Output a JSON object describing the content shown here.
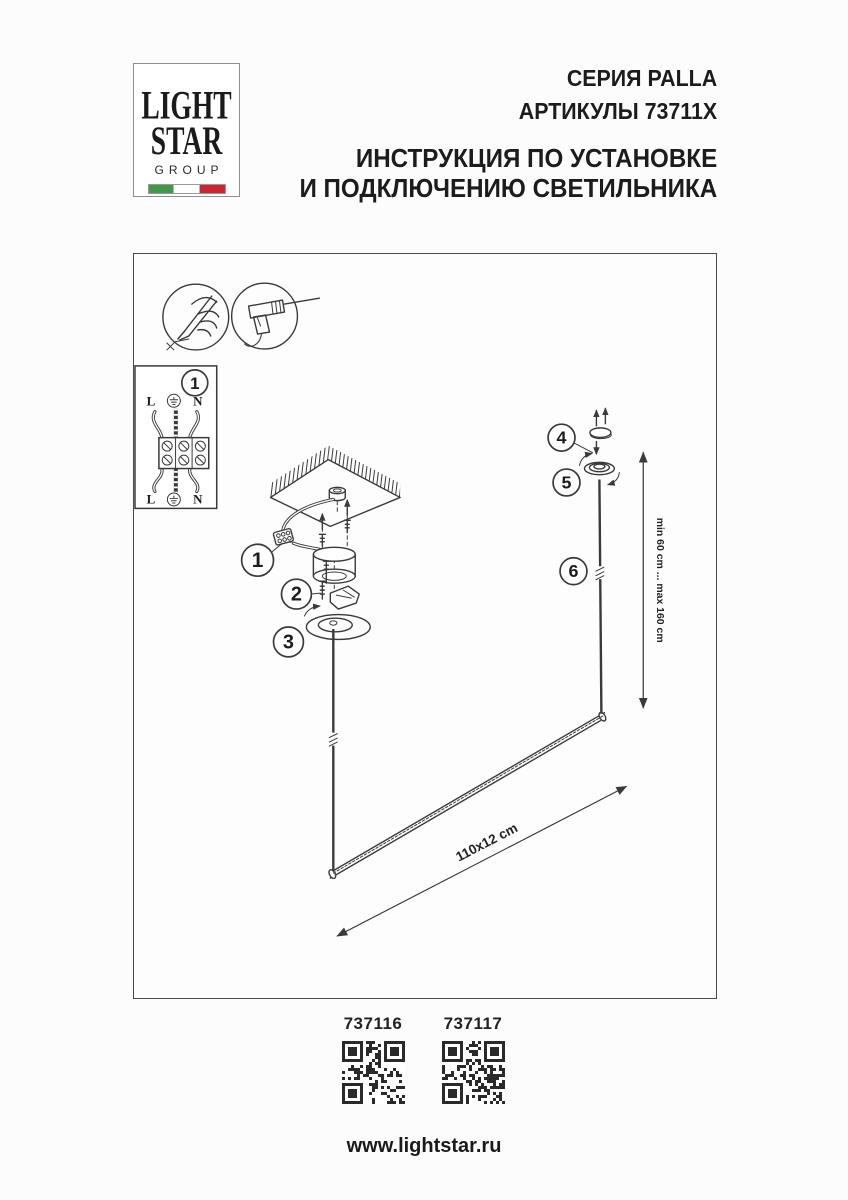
{
  "header": {
    "logo": {
      "line1": "LIGHT",
      "line2": "STAR",
      "line3": "GROUP"
    },
    "series": "СЕРИЯ PALLA",
    "articles": "АРТИКУЛЫ 73711X",
    "instruction_line1": "ИНСТРУКЦИЯ ПО УСТАНОВКЕ",
    "instruction_line2": "И ПОДКЛЮЧЕНИЮ СВЕТИЛЬНИКА"
  },
  "diagram": {
    "steps": [
      "1",
      "2",
      "3",
      "4",
      "5",
      "6"
    ],
    "wiring": {
      "step_ref": "1",
      "l_top": "L",
      "n_top": "N",
      "l_bottom": "L",
      "n_bottom": "N"
    },
    "dimensions": {
      "height_range": "min 60 cm ... max 160 cm",
      "bar_size": "110x12 cm"
    },
    "icons": [
      "wire-stripper-icon",
      "drill-icon",
      "ground-icon"
    ]
  },
  "qr_codes": [
    {
      "label": "737116"
    },
    {
      "label": "737117"
    }
  ],
  "footer": {
    "url": "www.lightstar.ru"
  },
  "colors": {
    "flag_green": "#3f9b49",
    "flag_red": "#cc2431",
    "ink": "#3a3a3a"
  }
}
